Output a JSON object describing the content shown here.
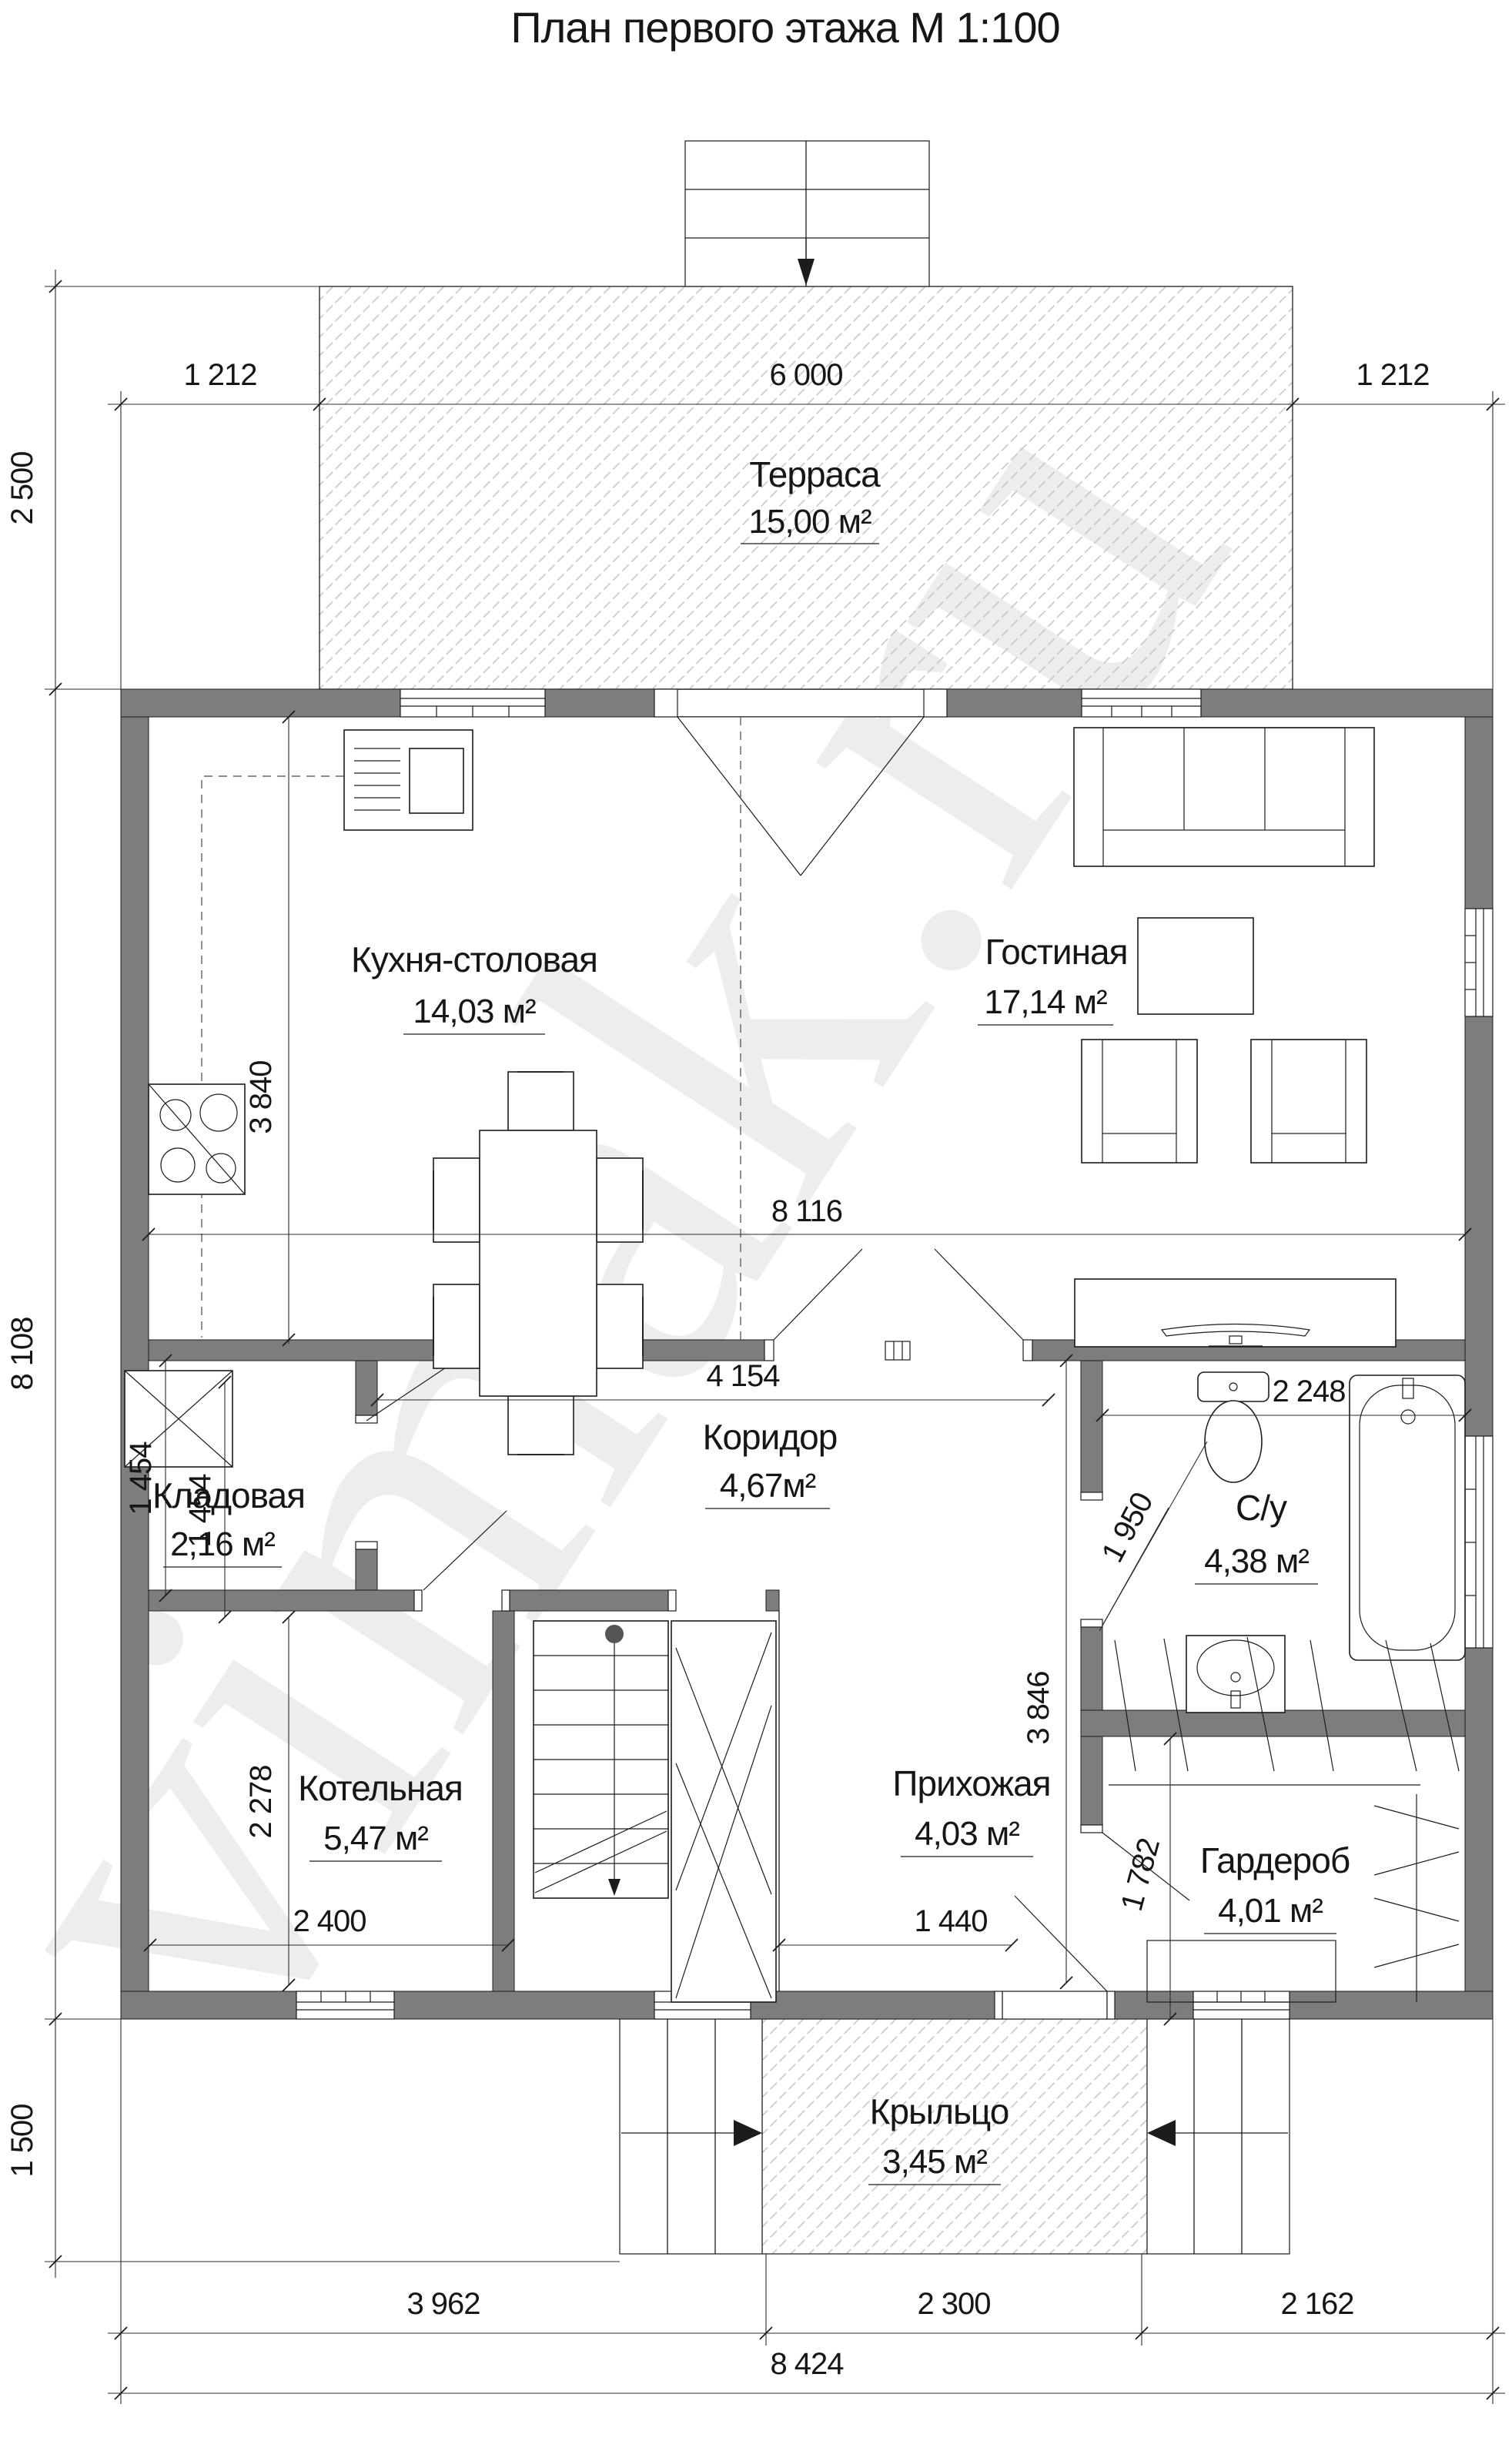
{
  "title": "План первого этажа М 1:100",
  "watermark": "vimak.ru",
  "colors": {
    "wall": "#7d7d7d",
    "line": "#1c1c1c",
    "hatch": "#c3c3c3",
    "watermark": "#ededed"
  },
  "rooms": {
    "terrace": {
      "name": "Терраса",
      "area": "15,00 м²"
    },
    "kitchen": {
      "name": "Кухня-столовая",
      "area": "14,03 м²"
    },
    "living": {
      "name": "Гостиная",
      "area": "17,14 м²"
    },
    "corridor": {
      "name": "Коридор",
      "area": "4,67м²"
    },
    "pantry": {
      "name": "Кладовая",
      "area": "2,16 м²"
    },
    "bathroom": {
      "name": "С/у",
      "area": "4,38 м²"
    },
    "boiler": {
      "name": "Котельная",
      "area": "5,47 м²"
    },
    "hall": {
      "name": "Прихожая",
      "area": "4,03 м²"
    },
    "wardrobe": {
      "name": "Гардероб",
      "area": "4,01 м²"
    },
    "porch": {
      "name": "Крыльцо",
      "area": "3,45 м²"
    }
  },
  "dims": {
    "top": [
      "1 212",
      "6 000",
      "1 212"
    ],
    "left": [
      "2 500",
      "8 108",
      "1 500"
    ],
    "bottom": [
      "3 962",
      "2 300",
      "2 162"
    ],
    "total": "8 424",
    "inner": {
      "living_width": "8 116",
      "corridor_width": "4 154",
      "kitchen_depth": "3 840",
      "pantry_a": "1 454",
      "pantry_b": "1 454",
      "boiler_height": "2 278",
      "boiler_width": "2 400",
      "hall_width": "1 440",
      "bath_width": "2 248",
      "bath_door": "1 950",
      "hall_height": "3 846",
      "wardrobe_height": "1 782"
    }
  }
}
